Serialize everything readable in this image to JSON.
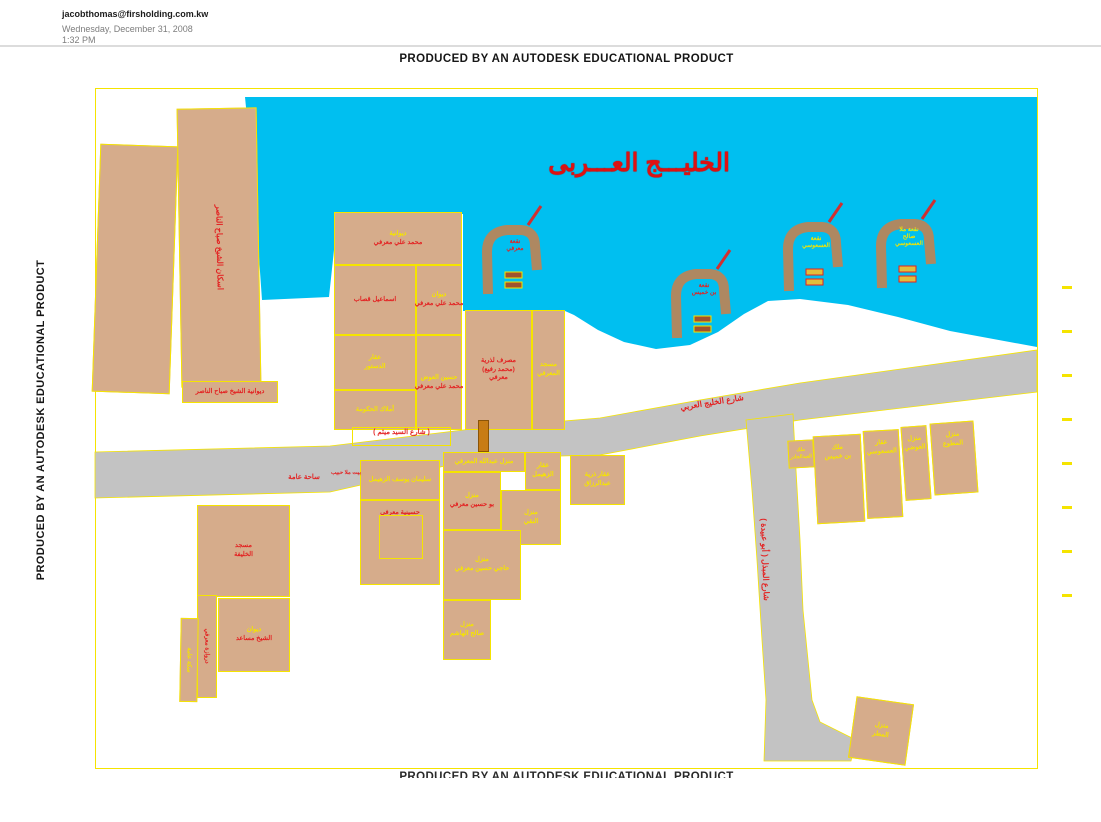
{
  "header": {
    "email": "jacobthomas@firsholding.com.kw",
    "date": "Wednesday, December 31, 2008",
    "time": "1:32 PM"
  },
  "banners": {
    "top": "PRODUCED BY AN AUTODESK EDUCATIONAL PRODUCT",
    "left": "PRODUCED BY AN AUTODESK EDUCATIONAL PRODUCT",
    "bottom": "PRODUCED BY AN AUTODESK EDUCATIONAL PRODUCT"
  },
  "colors": {
    "water": "#00BFF0",
    "building": "#D6AC8B",
    "outline": "#F5E400",
    "road": "#C3C3C3",
    "pier": "#AE8861",
    "red": "#E32222",
    "yellow": "#F5E400",
    "title_red": "#DE1111",
    "orange": "#C87C14"
  },
  "map": {
    "sea_title": "الخليـــج العـــربى",
    "water_points": "245,97 1037,97 1037,347 950,331 898,317 848,305 800,299 768,301 744,314 718,332 690,345 656,349 624,342 598,330 574,315 565,311 463,311 463,214 334,214 334,250 329,297 262,300 255,200",
    "roads": [
      {
        "name": "gulf-road",
        "points": "95,452 330,446 480,428 600,418 700,400 800,383 1037,350 1037,392 800,420 700,436 600,455 480,458 330,492 95,498"
      },
      {
        "name": "abu-obaida-road",
        "points": "746,420 793,414 796,470 800,540 803,610 808,660 812,700 820,722 856,740 851,761 764,761 766,700 762,640 757,560 752,490"
      }
    ],
    "orange_bar": {
      "x": 478,
      "y": 420,
      "w": 11,
      "h": 32
    },
    "ticks": {
      "x": 1062,
      "ys": [
        286,
        330,
        374,
        418,
        462,
        506,
        550,
        594
      ]
    },
    "buildings": [
      {
        "id": "slab-left",
        "x": 96,
        "y": 145,
        "w": 78,
        "h": 248,
        "rot": 2,
        "lines": []
      },
      {
        "id": "tower",
        "x": 179,
        "y": 108,
        "w": 80,
        "h": 279,
        "rot": -1,
        "vertical": true,
        "lsize": 8,
        "lines": [
          {
            "t": "اسكان الشيخ صباح الناصر",
            "c": "r"
          }
        ]
      },
      {
        "id": "tower-foot",
        "x": 182,
        "y": 381,
        "w": 96,
        "h": 22,
        "lines": [
          {
            "t": "ديوانية الشيخ صباح الناصر",
            "c": "r"
          }
        ]
      },
      {
        "id": "plot-marafi-1",
        "x": 334,
        "y": 212,
        "w": 128,
        "h": 53,
        "lines": [
          {
            "t": "ديوانية",
            "c": "y"
          },
          {
            "t": "محمد علي معرفي",
            "c": "r"
          }
        ]
      },
      {
        "id": "plot-qassab",
        "x": 334,
        "y": 265,
        "w": 82,
        "h": 70,
        "lines": [
          {
            "t": "اسماعيل قصاب",
            "c": "r"
          }
        ]
      },
      {
        "id": "plot-marafi-2",
        "x": 416,
        "y": 265,
        "w": 46,
        "h": 70,
        "lines": [
          {
            "t": "ديوان",
            "c": "y"
          },
          {
            "t": "محمد علي معرفي",
            "c": "r"
          }
        ]
      },
      {
        "id": "plot-dastour",
        "x": 334,
        "y": 335,
        "w": 82,
        "h": 55,
        "lines": [
          {
            "t": "عقار",
            "c": "y"
          },
          {
            "t": "الدستور",
            "c": "y"
          }
        ]
      },
      {
        "id": "plot-marafi-3",
        "x": 416,
        "y": 335,
        "w": 46,
        "h": 95,
        "lines": [
          {
            "t": "حسين العوض",
            "c": "y"
          },
          {
            "t": "محمد علي معرفي",
            "c": "r"
          }
        ]
      },
      {
        "id": "plot-govt",
        "x": 334,
        "y": 390,
        "w": 82,
        "h": 40,
        "lines": [
          {
            "t": "أملاك الحكومة",
            "c": "y"
          }
        ]
      },
      {
        "id": "plot-rafie",
        "x": 465,
        "y": 310,
        "w": 67,
        "h": 120,
        "lines": [
          {
            "t": "مصرف لذرية",
            "c": "r"
          },
          {
            "t": "(محمد رفيع)",
            "c": "r"
          },
          {
            "t": "معرفي",
            "c": "r"
          }
        ]
      },
      {
        "id": "plot-mosque-marafi",
        "x": 532,
        "y": 310,
        "w": 33,
        "h": 120,
        "lines": [
          {
            "t": "مسجد",
            "c": "y"
          },
          {
            "t": "المعرفي",
            "c": "y"
          }
        ]
      },
      {
        "id": "mosque-khalifa",
        "x": 197,
        "y": 505,
        "w": 93,
        "h": 92,
        "lines": [
          {
            "t": "مسجد",
            "c": "r"
          },
          {
            "t": "الخليفة",
            "c": "r"
          }
        ]
      },
      {
        "id": "diwan-sheikh",
        "x": 218,
        "y": 598,
        "w": 72,
        "h": 74,
        "lines": [
          {
            "t": "ديوان",
            "c": "y"
          },
          {
            "t": "الشيخ مساعد",
            "c": "r"
          }
        ]
      },
      {
        "id": "strip-darwaza",
        "x": 197,
        "y": 595,
        "w": 20,
        "h": 103,
        "vertical": true,
        "lsize": 6,
        "lines": [
          {
            "t": "دروازة معرفي",
            "c": "r"
          }
        ]
      },
      {
        "id": "strip-sikka",
        "x": 180,
        "y": 618,
        "w": 18,
        "h": 84,
        "rot": 1,
        "vertical": true,
        "lsize": 6,
        "lines": [
          {
            "t": "سكة عامة",
            "c": "y"
          }
        ]
      },
      {
        "id": "plot-zuhaimel-1",
        "x": 360,
        "y": 460,
        "w": 80,
        "h": 40,
        "lines": [
          {
            "t": "سليمان يوسف الزهيمل",
            "c": "y"
          }
        ]
      },
      {
        "id": "husseiniya",
        "x": 360,
        "y": 500,
        "w": 80,
        "h": 85,
        "ltop": true,
        "inner": {
          "x": 18,
          "y": 14,
          "w": 42,
          "h": 42
        },
        "lines": [
          {
            "t": "حسينية معرفي",
            "c": "r"
          }
        ]
      },
      {
        "id": "plot-abdullah",
        "x": 443,
        "y": 452,
        "w": 82,
        "h": 20,
        "lines": [
          {
            "t": "منزل عبدالله المعرفي",
            "c": "y"
          }
        ]
      },
      {
        "id": "plot-zuhaimel-2",
        "x": 525,
        "y": 452,
        "w": 36,
        "h": 38,
        "lines": [
          {
            "t": "عقار",
            "c": "y"
          },
          {
            "t": "الزهيمل",
            "c": "y"
          }
        ]
      },
      {
        "id": "plot-bohussein",
        "x": 443,
        "y": 472,
        "w": 58,
        "h": 58,
        "lines": [
          {
            "t": "منزل",
            "c": "y"
          },
          {
            "t": "بو حسين معرفي",
            "c": "r"
          }
        ]
      },
      {
        "id": "plot-naqi",
        "x": 501,
        "y": 490,
        "w": 60,
        "h": 55,
        "lines": [
          {
            "t": "منزل",
            "c": "y"
          },
          {
            "t": "النقي",
            "c": "y"
          }
        ]
      },
      {
        "id": "plot-haji",
        "x": 443,
        "y": 530,
        "w": 78,
        "h": 70,
        "lines": [
          {
            "t": "منزل",
            "c": "y"
          },
          {
            "t": "حاجي حسين معرفي",
            "c": "y"
          }
        ]
      },
      {
        "id": "plot-hashem",
        "x": 443,
        "y": 600,
        "w": 48,
        "h": 60,
        "lines": [
          {
            "t": "منزل",
            "c": "y"
          },
          {
            "t": "صالح الهاشم",
            "c": "y"
          }
        ]
      },
      {
        "id": "plot-abdulrazzaq",
        "x": 570,
        "y": 455,
        "w": 55,
        "h": 50,
        "lines": [
          {
            "t": "عقار ذرية",
            "c": "y"
          },
          {
            "t": "عبدالرزاق",
            "c": "y"
          }
        ]
      },
      {
        "id": "plot-abduljader",
        "x": 788,
        "y": 440,
        "w": 26,
        "h": 28,
        "rot": -3,
        "lsize": 5,
        "lines": [
          {
            "t": "ملك",
            "c": "y"
          },
          {
            "t": "العبدالجادر",
            "c": "y"
          }
        ]
      },
      {
        "id": "plot-binkhamis",
        "x": 815,
        "y": 435,
        "w": 48,
        "h": 88,
        "rot": -3,
        "ltop": true,
        "lines": [
          {
            "t": "ملك",
            "c": "y"
          },
          {
            "t": "بن خميس",
            "c": "y"
          }
        ]
      },
      {
        "id": "plot-asousi",
        "x": 865,
        "y": 430,
        "w": 36,
        "h": 88,
        "rot": -3,
        "ltop": true,
        "lines": [
          {
            "t": "عقار",
            "c": "y"
          },
          {
            "t": "العسعوسي",
            "c": "y"
          }
        ]
      },
      {
        "id": "plot-awadhi",
        "x": 903,
        "y": 426,
        "w": 26,
        "h": 74,
        "rot": -4,
        "ltop": true,
        "lines": [
          {
            "t": "منزل",
            "c": "y"
          },
          {
            "t": "العوضي",
            "c": "y"
          }
        ]
      },
      {
        "id": "plot-mutawa",
        "x": 932,
        "y": 422,
        "w": 44,
        "h": 72,
        "rot": -4,
        "ltop": true,
        "lines": [
          {
            "t": "منزل",
            "c": "y"
          },
          {
            "t": "المطوع",
            "c": "y"
          }
        ]
      },
      {
        "id": "plot-matar",
        "x": 852,
        "y": 700,
        "w": 58,
        "h": 62,
        "rot": 8,
        "lines": [
          {
            "t": "منزل",
            "c": "y"
          },
          {
            "t": "المطر",
            "c": "y"
          }
        ]
      }
    ],
    "piers": [
      {
        "id": "pier-marafi",
        "cx": 515,
        "cy": 258,
        "c": "r",
        "lines": [
          "نقعة",
          "معرفي"
        ]
      },
      {
        "id": "pier-binkhamis",
        "cx": 704,
        "cy": 302,
        "c": "r",
        "lines": [
          "نقعة",
          "بن خميس"
        ]
      },
      {
        "id": "pier-asousi",
        "cx": 816,
        "cy": 255,
        "c": "y",
        "lines": [
          "نقعة",
          "العسعوسي"
        ]
      },
      {
        "id": "pier-mulla-saleh",
        "cx": 909,
        "cy": 252,
        "c": "y",
        "lines": [
          "نقعة ملا",
          "صالح",
          "العسعوسي"
        ]
      }
    ],
    "road_labels": [
      {
        "id": "seyed-maitham-street",
        "text": "( شارع السيد ميثم )",
        "x": 352,
        "y": 427,
        "w": 97,
        "h": 17,
        "c": "r",
        "size": 7,
        "box": true
      },
      {
        "id": "gulf-street",
        "text": "شارع الخليج العربي",
        "x": 662,
        "y": 398,
        "w": 100,
        "c": "r",
        "size": 8,
        "rot": -9
      },
      {
        "id": "abu-obaida-street",
        "text": "شارع المبذل ( أبو عبيدة )",
        "x": 695,
        "y": 555,
        "w": 140,
        "c": "r",
        "size": 8,
        "rot": 88
      },
      {
        "id": "public-square",
        "text": "ساحة عامة",
        "x": 276,
        "y": 473,
        "w": 56,
        "c": "r",
        "size": 7
      },
      {
        "id": "mulla-habib-house",
        "text": "بيت ملا حبيب",
        "x": 331,
        "y": 470,
        "w": 30,
        "c": "r",
        "size": 5.5
      }
    ]
  }
}
